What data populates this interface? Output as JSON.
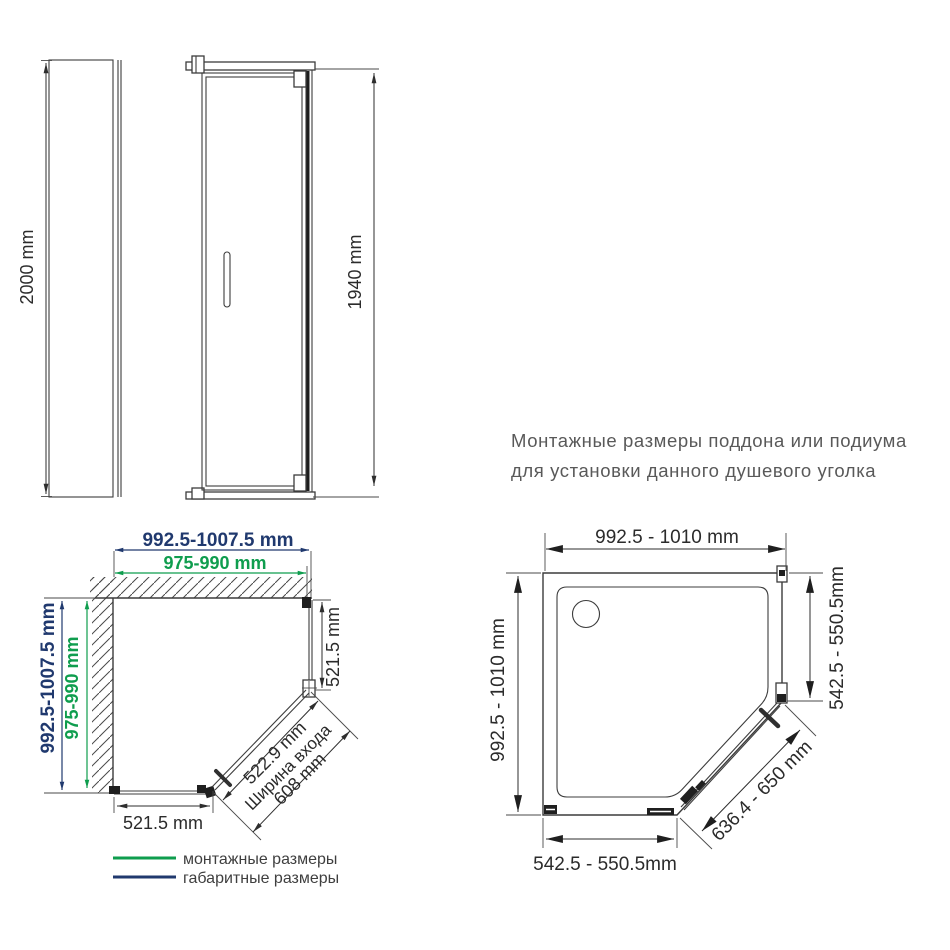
{
  "title": {
    "line1": "Монтажные размеры поддона или подиума",
    "line2": "для установки данного душевого уголка"
  },
  "elevation": {
    "total_height": "2000 mm",
    "glass_height": "1940 mm"
  },
  "plan_overall": {
    "top_overall": "992.5-1007.5 mm",
    "top_mounting": "975-990 mm",
    "left_overall": "992.5-1007.5 mm",
    "left_mounting": "975-990 mm",
    "right_side": "521.5 mm",
    "bottom_side": "521.5 mm",
    "entry_width": "522.9 mm",
    "entry_caption": "Ширина входа",
    "door_diagonal": "608 mm"
  },
  "legend": {
    "mounting_label": "монтажные размеры",
    "overall_label": "габаритные размеры",
    "mounting_color": "#0f9d4e",
    "overall_color": "#20396e"
  },
  "tray_plan": {
    "top_width": "992.5 - 1010 mm",
    "left_depth": "992.5 - 1010 mm",
    "right_side": "542.5 - 550.5mm",
    "bottom_side": "542.5 - 550.5mm",
    "diagonal": "636.4 - 650 mm"
  }
}
